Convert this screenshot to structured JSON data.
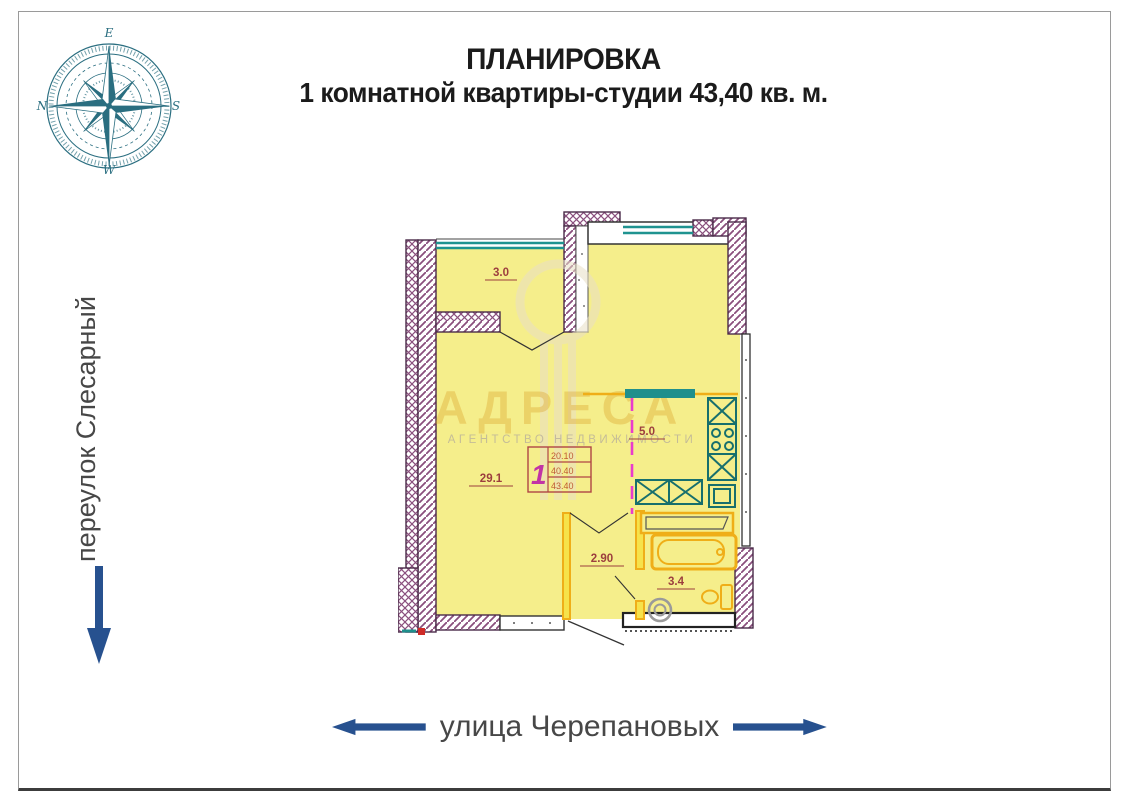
{
  "title": {
    "line1": "ПЛАНИРОВКА",
    "line2": "1 комнатной квартиры-студии 43,40 кв. м."
  },
  "streets": {
    "left": "переулок Слесарный",
    "bottom": "улица Черепановых"
  },
  "compass": {
    "top": "E",
    "right": "S",
    "bottom": "W",
    "left": "N"
  },
  "plan": {
    "areas": {
      "loggia": "3.0",
      "living_room": "29.1",
      "kitchen": "5.0",
      "hallway": "2.90",
      "bathroom": "3.4"
    },
    "stamp": {
      "rooms": "1",
      "living_area": "20.10",
      "auxiliary_area": "40.40",
      "total_area": "43.40"
    }
  },
  "watermark": {
    "brand": "АДРЕСА",
    "subtitle": "АГЕНТСТВО НЕДВИЖИМОСТИ"
  },
  "colors": {
    "navy_arrow": "#27518f",
    "teal": "#1f8f8c",
    "wall_hatch": "#8a4f7d",
    "room_fill": "#f5ee8b",
    "fixture_orange": "#efae18",
    "zone_magenta": "#e93ccc",
    "stamp_pink": "#c233a6",
    "label_red": "#9c3e3e",
    "compass_teal": "#2a6e80"
  }
}
